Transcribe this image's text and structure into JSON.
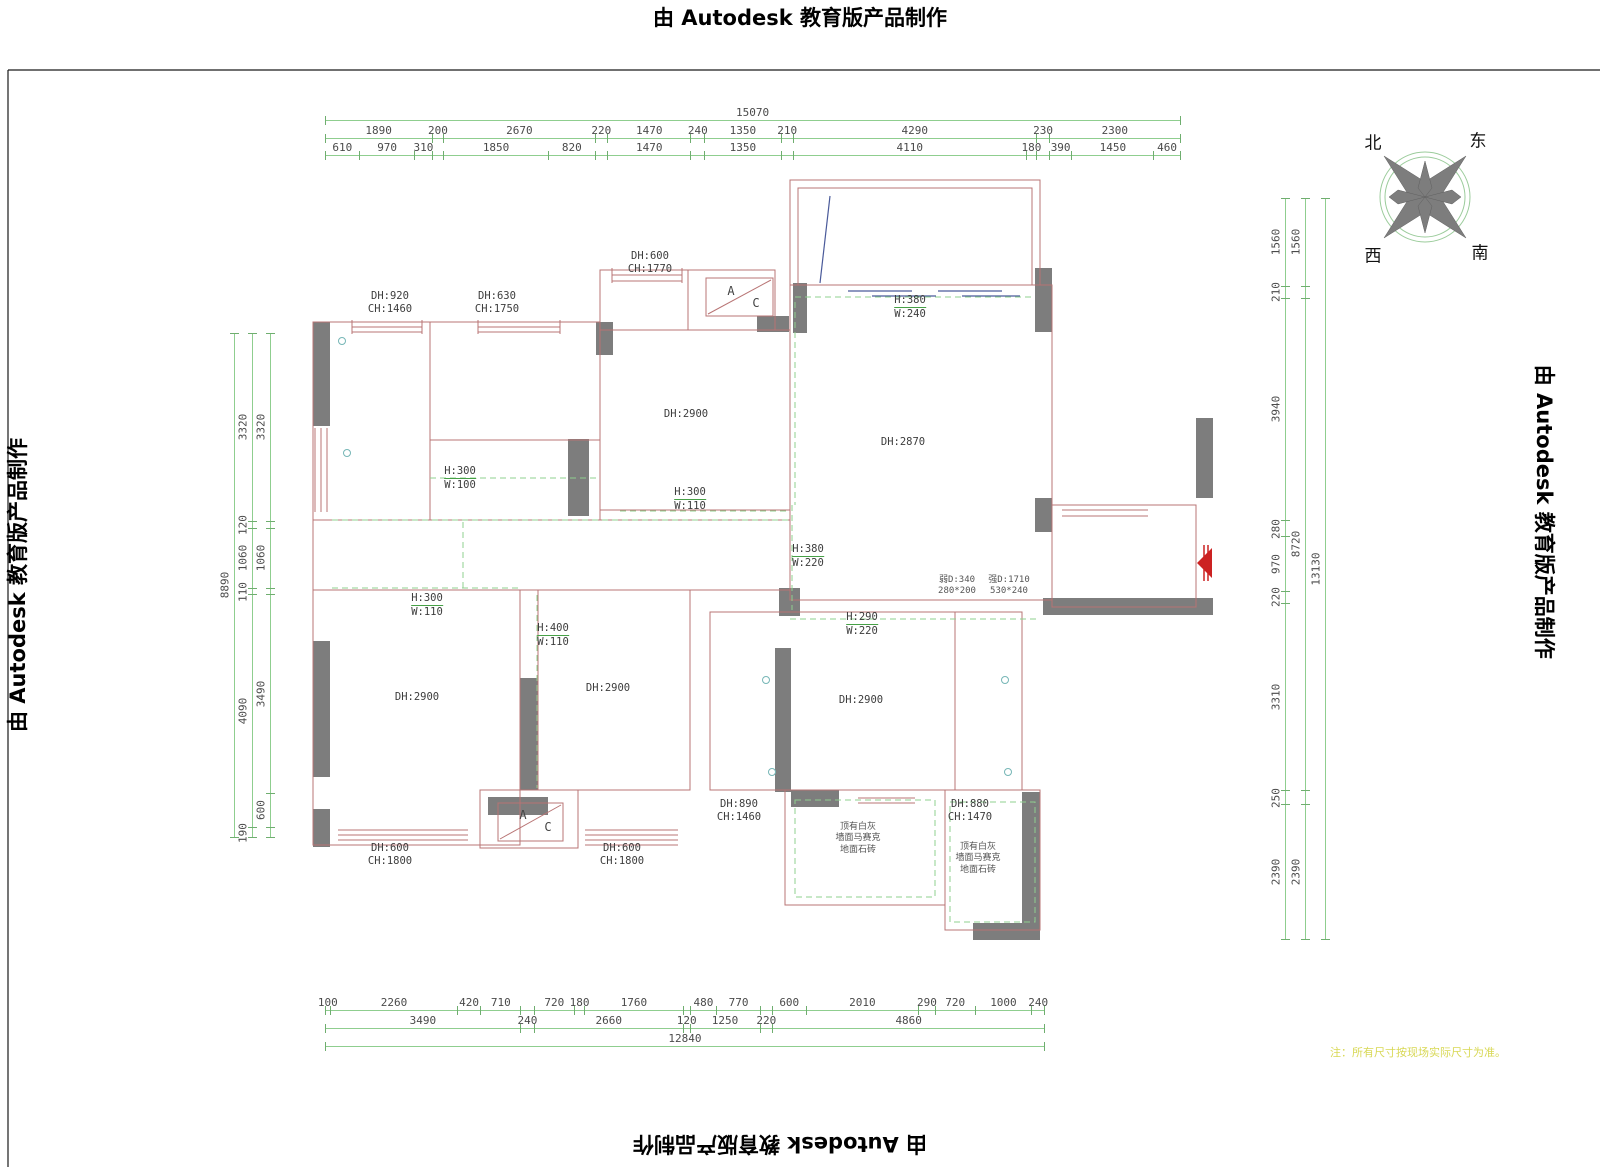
{
  "watermark": {
    "text": "由 Autodesk 教育版产品制作"
  },
  "note": {
    "text": "注：所有尺寸按现场实际尺寸为准。"
  },
  "compass": {
    "north": "北",
    "east": "东",
    "west": "西",
    "south": "南"
  },
  "colors": {
    "dim_green": "#8fce8f",
    "wall_red": "#b87474",
    "wall_gray": "#7d7d7d",
    "window_blue": "#4a5a9a",
    "dashed_green": "#8fd08f",
    "door_red": "#cc2222",
    "note_yellow": "#d8d855"
  },
  "dimensions": {
    "top": {
      "overall": [
        {
          "len": 15070,
          "label": "15070"
        }
      ],
      "row1": [
        {
          "len": 1890,
          "label": "1890"
        },
        {
          "len": 200,
          "label": "200"
        },
        {
          "len": 2670,
          "label": "2670"
        },
        {
          "len": 220,
          "label": "220"
        },
        {
          "len": 1470,
          "label": "1470"
        },
        {
          "len": 240,
          "label": "240"
        },
        {
          "len": 1350,
          "label": "1350"
        },
        {
          "len": 210,
          "label": "210"
        },
        {
          "len": 4290,
          "label": "4290"
        },
        {
          "len": 230,
          "label": "230"
        },
        {
          "len": 2300,
          "label": "2300"
        }
      ],
      "row2": [
        {
          "len": 610,
          "label": "610"
        },
        {
          "len": 970,
          "label": "970"
        },
        {
          "len": 310,
          "label": "310"
        },
        {
          "len": 200,
          "label": ""
        },
        {
          "len": 1850,
          "label": "1850"
        },
        {
          "len": 820,
          "label": "820"
        },
        {
          "len": 220,
          "label": ""
        },
        {
          "len": 1470,
          "label": "1470"
        },
        {
          "len": 240,
          "label": ""
        },
        {
          "len": 1350,
          "label": "1350"
        },
        {
          "len": 210,
          "label": ""
        },
        {
          "len": 4110,
          "label": "4110"
        },
        {
          "len": 180,
          "label": "180"
        },
        {
          "len": 230,
          "label": ""
        },
        {
          "len": 390,
          "label": "390"
        },
        {
          "len": 1450,
          "label": "1450"
        },
        {
          "len": 460,
          "label": "460"
        }
      ]
    },
    "bottom": {
      "row1": [
        {
          "len": 100,
          "label": "100"
        },
        {
          "len": 2260,
          "label": "2260"
        },
        {
          "len": 420,
          "label": "420"
        },
        {
          "len": 710,
          "label": "710"
        },
        {
          "len": 240,
          "label": ""
        },
        {
          "len": 720,
          "label": "720"
        },
        {
          "len": 180,
          "label": "180"
        },
        {
          "len": 1760,
          "label": "1760"
        },
        {
          "len": 120,
          "label": ""
        },
        {
          "len": 480,
          "label": "480"
        },
        {
          "len": 770,
          "label": "770"
        },
        {
          "len": 220,
          "label": ""
        },
        {
          "len": 600,
          "label": "600"
        },
        {
          "len": 2010,
          "label": "2010"
        },
        {
          "len": 290,
          "label": "290"
        },
        {
          "len": 720,
          "label": "720"
        },
        {
          "len": 1000,
          "label": "1000"
        },
        {
          "len": 240,
          "label": "240"
        }
      ],
      "row2": [
        {
          "len": 3490,
          "label": "3490"
        },
        {
          "len": 240,
          "label": "240"
        },
        {
          "len": 2660,
          "label": "2660"
        },
        {
          "len": 120,
          "label": "120"
        },
        {
          "len": 1250,
          "label": "1250"
        },
        {
          "len": 220,
          "label": "220"
        },
        {
          "len": 4860,
          "label": "4860"
        }
      ],
      "overall": [
        {
          "len": 12840,
          "label": "12840"
        }
      ]
    },
    "left": {
      "overall": [
        {
          "len": 8890,
          "label": "8890"
        }
      ],
      "row1": [
        {
          "len": 3320,
          "label": "3320"
        },
        {
          "len": 120,
          "label": "120"
        },
        {
          "len": 1060,
          "label": "1060"
        },
        {
          "len": 110,
          "label": "110"
        },
        {
          "len": 4090,
          "label": "4090"
        },
        {
          "len": 190,
          "label": "190"
        }
      ],
      "row2": [
        {
          "len": 3320,
          "label": "3320"
        },
        {
          "len": 120,
          "label": ""
        },
        {
          "len": 1060,
          "label": "1060"
        },
        {
          "len": 110,
          "label": ""
        },
        {
          "len": 3490,
          "label": "3490"
        },
        {
          "len": 600,
          "label": "600"
        },
        {
          "len": 190,
          "label": ""
        }
      ]
    },
    "right": {
      "row2": [
        {
          "len": 1560,
          "label": "1560"
        },
        {
          "len": 210,
          "label": "210"
        },
        {
          "len": 3940,
          "label": "3940"
        },
        {
          "len": 280,
          "label": "280"
        },
        {
          "len": 970,
          "label": "970"
        },
        {
          "len": 220,
          "label": "220"
        },
        {
          "len": 3310,
          "label": "3310"
        },
        {
          "len": 250,
          "label": "250"
        },
        {
          "len": 2390,
          "label": "2390"
        }
      ],
      "row1": [
        {
          "len": 1560,
          "label": "1560"
        },
        {
          "len": 210,
          "label": ""
        },
        {
          "len": 8720,
          "label": "8720"
        },
        {
          "len": 250,
          "label": ""
        },
        {
          "len": 2390,
          "label": "2390"
        }
      ],
      "overall": [
        {
          "len": 13130,
          "label": "13130"
        }
      ]
    }
  },
  "annotations": [
    {
      "x": 390,
      "y": 290,
      "lines": [
        "DH:920",
        "CH:1460"
      ]
    },
    {
      "x": 497,
      "y": 290,
      "lines": [
        "DH:630",
        "CH:1750"
      ]
    },
    {
      "x": 650,
      "y": 250,
      "lines": [
        "DH:600",
        "CH:1770"
      ]
    },
    {
      "x": 686,
      "y": 408,
      "lines": [
        "DH:2900"
      ]
    },
    {
      "x": 910,
      "y": 294,
      "lines": [
        "H:380",
        "W:240"
      ],
      "cls": "beam"
    },
    {
      "x": 903,
      "y": 436,
      "lines": [
        "DH:2870"
      ]
    },
    {
      "x": 460,
      "y": 465,
      "lines": [
        "H:300",
        "W:100"
      ],
      "cls": "beam"
    },
    {
      "x": 690,
      "y": 486,
      "lines": [
        "H:300",
        "W:110"
      ],
      "cls": "beam"
    },
    {
      "x": 808,
      "y": 543,
      "lines": [
        "H:380",
        "W:220"
      ],
      "cls": "beam"
    },
    {
      "x": 427,
      "y": 592,
      "lines": [
        "H:300",
        "W:110"
      ],
      "cls": "beam"
    },
    {
      "x": 553,
      "y": 622,
      "lines": [
        "H:400",
        "W:110"
      ],
      "cls": "beam"
    },
    {
      "x": 862,
      "y": 611,
      "lines": [
        "H:290",
        "W:220"
      ],
      "cls": "beam"
    },
    {
      "x": 957,
      "y": 575,
      "lines": [
        "弱D:340",
        "280*200"
      ],
      "cls": "tiny"
    },
    {
      "x": 1009,
      "y": 575,
      "lines": [
        "强D:1710",
        "530*240"
      ],
      "cls": "tiny"
    },
    {
      "x": 417,
      "y": 691,
      "lines": [
        "DH:2900"
      ]
    },
    {
      "x": 608,
      "y": 682,
      "lines": [
        "DH:2900"
      ]
    },
    {
      "x": 861,
      "y": 694,
      "lines": [
        "DH:2900"
      ]
    },
    {
      "x": 739,
      "y": 798,
      "lines": [
        "DH:890",
        "CH:1460"
      ]
    },
    {
      "x": 970,
      "y": 798,
      "lines": [
        "DH:880",
        "CH:1470"
      ]
    },
    {
      "x": 858,
      "y": 822,
      "lines": [
        "顶有白灰",
        "墙面马赛克",
        "地面石砖"
      ],
      "cls": "tiny"
    },
    {
      "x": 978,
      "y": 842,
      "lines": [
        "顶有白灰",
        "墙面马赛克",
        "地面石砖"
      ],
      "cls": "tiny"
    },
    {
      "x": 390,
      "y": 842,
      "lines": [
        "DH:600",
        "CH:1800"
      ]
    },
    {
      "x": 622,
      "y": 842,
      "lines": [
        "DH:600",
        "CH:1800"
      ]
    },
    {
      "x": 731,
      "y": 284,
      "lines": [
        "A"
      ],
      "cls": "ac"
    },
    {
      "x": 756,
      "y": 296,
      "lines": [
        "C"
      ],
      "cls": "ac"
    },
    {
      "x": 523,
      "y": 808,
      "lines": [
        "A"
      ],
      "cls": "ac"
    },
    {
      "x": 548,
      "y": 820,
      "lines": [
        "C"
      ],
      "cls": "ac"
    }
  ]
}
